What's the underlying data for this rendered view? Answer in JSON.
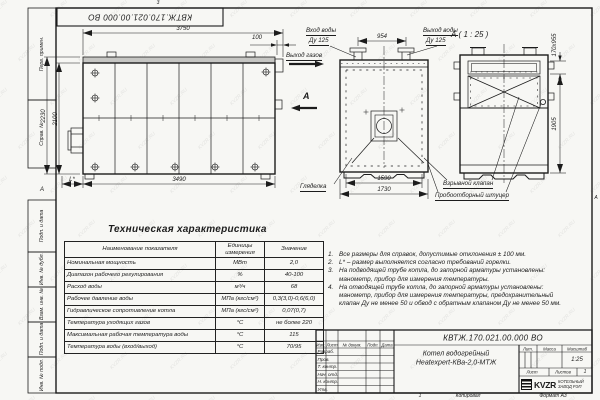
{
  "watermark": {
    "text": "KVZR.RU"
  },
  "doc_box": {
    "number": "КВТЖ.170.021.00.000 ВО"
  },
  "frame": {
    "left_stamps": [
      "Перв. примен.",
      "Справ. №",
      "Подп. и дата",
      "Инв. № дубл.",
      "Взам. инв. №",
      "Подп. и дата",
      "Инв. № подл."
    ],
    "zone_marker_left": "А",
    "zone_marker_right": "А",
    "top_zone_mark": "3"
  },
  "dims": {
    "d3750": "3750",
    "d100": "100",
    "d2230": "2230",
    "d2100": "2100",
    "d3490": "3490",
    "dL": "L*",
    "d954": "954",
    "d1590": "1590",
    "d1730": "1730",
    "d170x955": "170х955",
    "d1905": "1905"
  },
  "labels": {
    "water_inlet_1": "Вход воды",
    "water_inlet_2": "Ду 125",
    "water_outlet_1": "Выход воды",
    "water_outlet_2": "Ду 125",
    "gas_outlet": "Выход газов",
    "section_letter": "А",
    "section_view_title": "А ( 1 : 25 )",
    "sight_glass": "Гляделка",
    "explosion_valve": "Взрывной клапан",
    "sampling_fitting": "Пробоотборный штуцер"
  },
  "tech_table": {
    "title": "Техническая характеристика",
    "headers": [
      "Наименование показателя",
      "Единицы измерения",
      "Значение"
    ],
    "rows": [
      [
        "Номинальная мощность",
        "МВт",
        "2,0"
      ],
      [
        "Диапазон рабочего регулирования",
        "%",
        "40-100"
      ],
      [
        "Расход воды",
        "м³/ч",
        "68"
      ],
      [
        "Рабочее давление воды",
        "МПа (кгс/см²)",
        "0,3(3,0)-0,6(6,0)"
      ],
      [
        "Гидравлическое сопротивление котла",
        "МПа (кгс/см²)",
        "0,07(0,7)"
      ],
      [
        "Температура уходящих газов",
        "°С",
        "не более 220"
      ],
      [
        "Максимальная рабочая температура воды",
        "°С",
        "115"
      ],
      [
        "Температура воды (вход/выход)",
        "°С",
        "70/95"
      ]
    ]
  },
  "notes": {
    "items": [
      {
        "num": "1.",
        "text": "Все размеры для справок, допустимые отклонения ± 100 мм."
      },
      {
        "num": "2.",
        "text": "L* – размер выполняется согласно требований горелки."
      },
      {
        "num": "3.",
        "text": "На подводящей трубе котла, до запорной арматуры установлены: манометр, прибор для измерения температуры."
      },
      {
        "num": "4.",
        "text": "На отводящей трубе котла, до запорной арматуры установлены: манометр, прибор для измерения температуры, предохранительный клапан Ду не менее 50 и обвод с обратным клапаном Ду не менее 50 мм."
      }
    ]
  },
  "title_block": {
    "doc_number": "КВТЖ.170.021.00.000 ВО",
    "product_title_1": "Котел водогрейный",
    "product_title_2": "Heatexpert-КВа-2,0-МТЖ",
    "header_cols": [
      "Изм.",
      "Лист",
      "№ докум.",
      "Подп.",
      "Дата"
    ],
    "signature_rows": [
      "Разраб.",
      "Пров.",
      "Т. контр.",
      "Нач. отд.",
      "Н. контр.",
      "Утв."
    ],
    "lit_label": "Лит.",
    "mass_label": "Масса",
    "scale_label": "Масштаб",
    "scale_value": "1:25",
    "sheet_label": "Лист",
    "sheets_label": "Листов",
    "sheets_value": "1",
    "company": {
      "logo": "KVZR",
      "line1": "КОТЕЛЬНЫЙ",
      "line2": "ЗАВОД РЭП"
    },
    "copied_label": "Копировал",
    "format_label": "Формат А3",
    "bottom_number": "1"
  }
}
